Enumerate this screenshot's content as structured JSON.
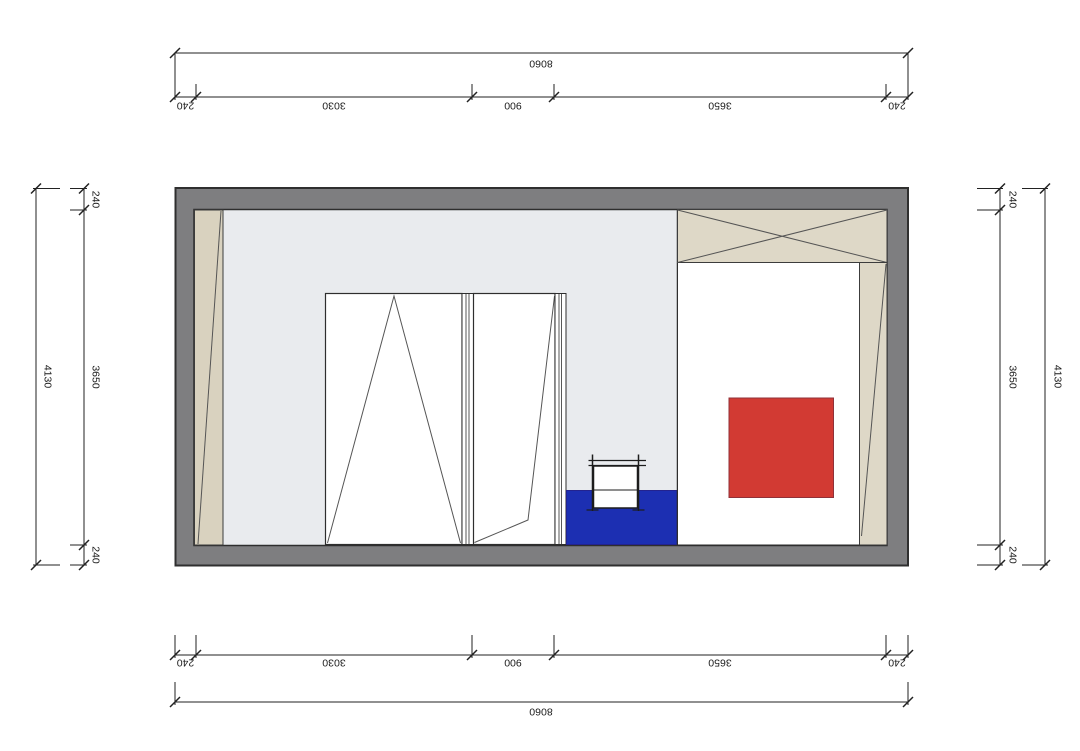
{
  "drawing": {
    "type": "architectural-plan",
    "dims": {
      "top": {
        "overall": "8060",
        "segments": [
          "240",
          "3030",
          "900",
          "3650",
          "240"
        ]
      },
      "bottom": {
        "overall": "8060",
        "segments": [
          "240",
          "3030",
          "900",
          "3650",
          "240"
        ]
      },
      "left": {
        "overall": "4130",
        "segments": [
          "240",
          "3650",
          "240"
        ]
      },
      "right": {
        "overall": "4130",
        "segments": [
          "240",
          "3650",
          "240"
        ]
      }
    },
    "colors": {
      "wall_gray": "#7e7e80",
      "floor_gray": "#e9ebee",
      "panel_white": "#ffffff",
      "beige": "#ded8c7",
      "beige_dark": "#d9d2bf",
      "accent_red": "#d23a33",
      "accent_blue": "#1c2fb2",
      "line": "#2e2e2e"
    }
  }
}
